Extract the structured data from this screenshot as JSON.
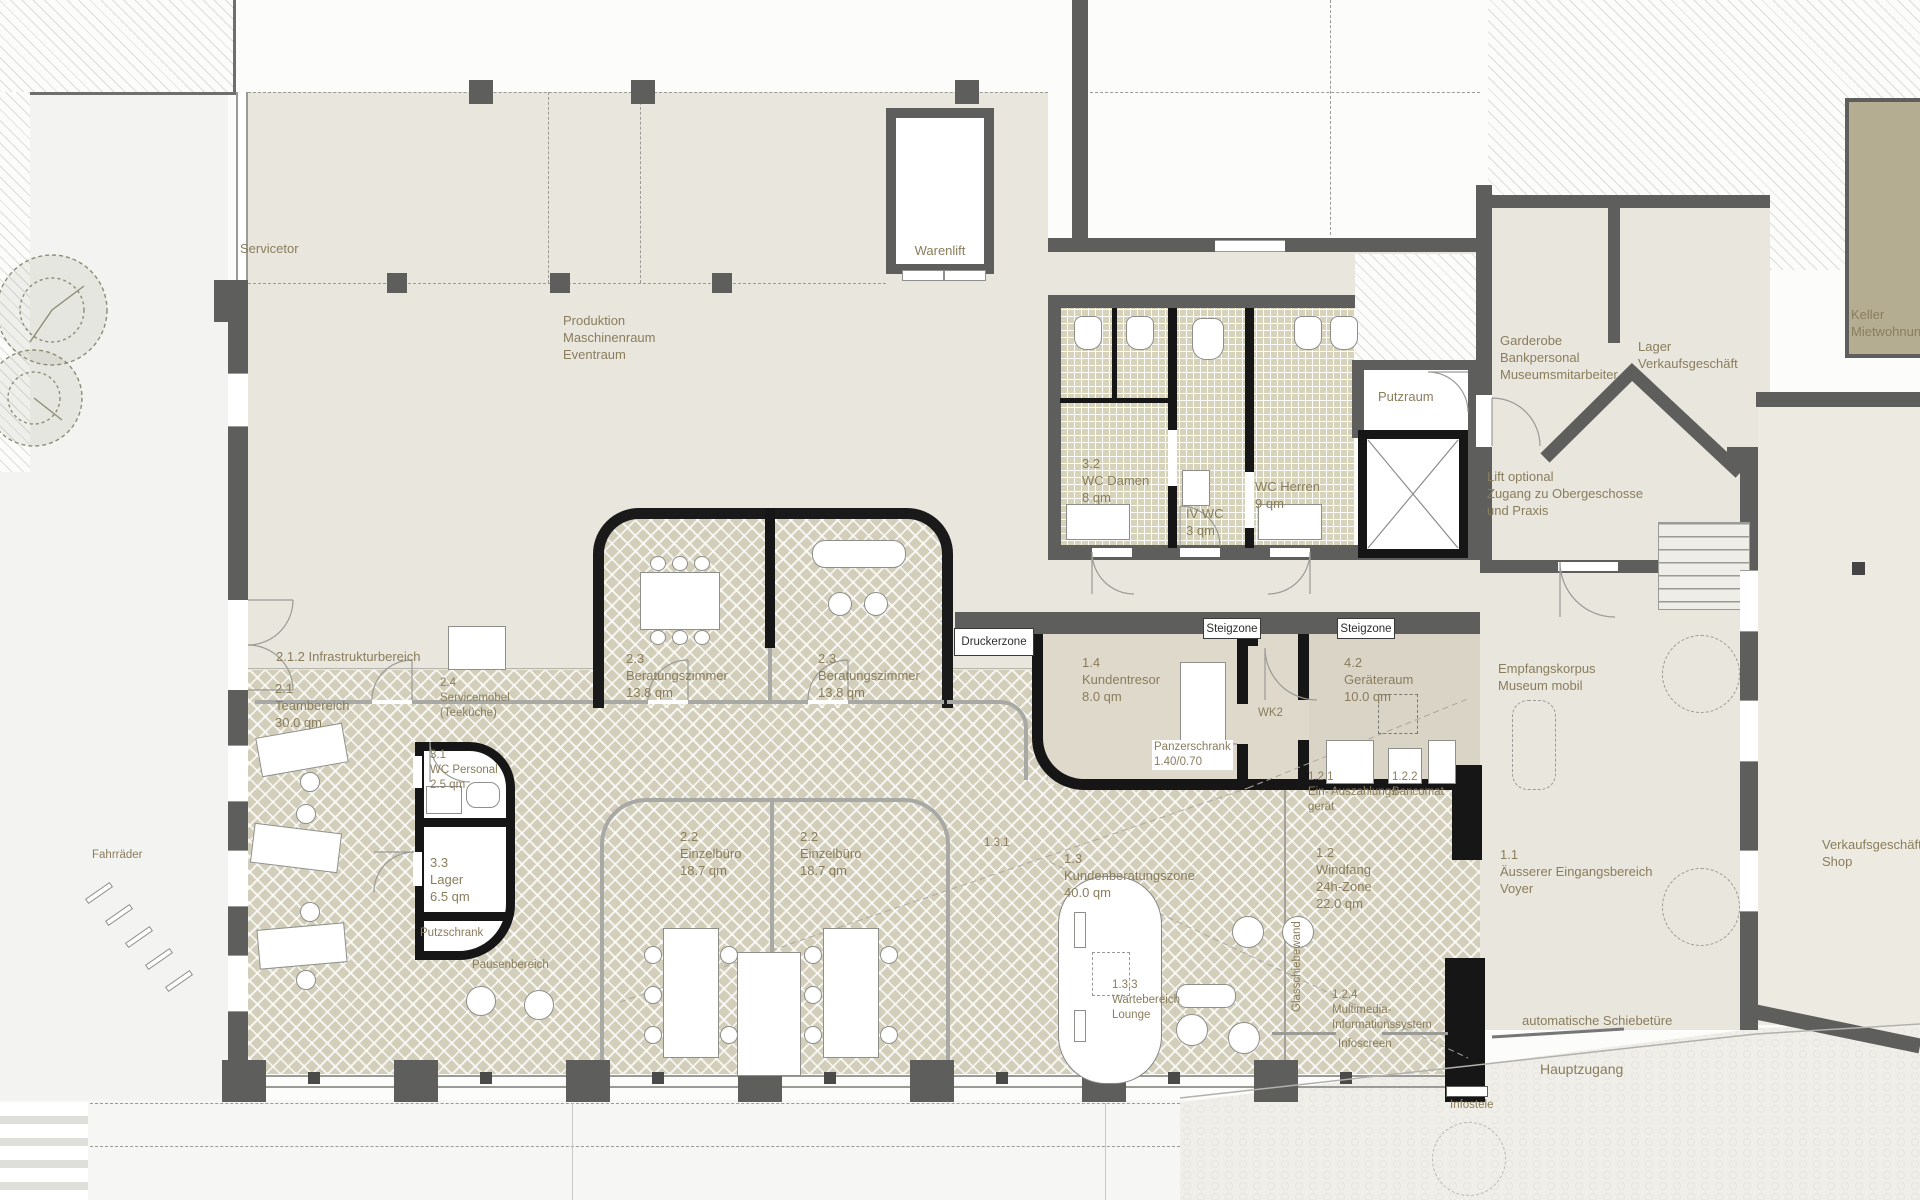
{
  "zones": {
    "exterior": {
      "servicetor": "Servicetor",
      "fahrraeder": "Fahrräder",
      "hauptzugang": "Hauptzugang",
      "infostele": "Infostele",
      "schiebetuere": "automatische Schiebetüre",
      "keller": "Keller\nMietwohnung"
    },
    "upper_hall": {
      "produktion": "Produktion\nMaschinenraum\nEventraum",
      "warenlift": "Warenlift",
      "infrastruktur": "2.1.2 Infrastrukturbereich",
      "druckerzone": "Druckerzone"
    },
    "wc_block": {
      "wc_damen": "3.2\nWC Damen\n8 qm",
      "iv_wc": "IV WC\n3 qm",
      "wc_herren": "WC Herren\n9 qm",
      "putzraum": "Putzraum"
    },
    "right_wing": {
      "garderobe": "Garderobe\nBankpersonal\nMuseumsmitarbeiter",
      "lager_verkauf": "Lager\nVerkaufsgeschäft",
      "lift_optional": "Lift optional\nZugang zu Obergeschosse\nund Praxis",
      "verkaufsgeschaeft": "Verkaufsgeschäft\nShop"
    },
    "bank": {
      "teambereich": "2.1\nTeambereich\n30.0 qm",
      "servicemoebel": "2.4\nServicemöbel\n(Teeküche)",
      "beratungszimmer": "2.3\nBeratungszimmer\n13.8 qm",
      "einzelbuero": "2.2\nEinzelbüro\n18.7 qm",
      "wc_personal": "3.1\nWC Personal\n2.5 qm",
      "lager": "3.3\nLager\n6.5 qm",
      "putzschrank": "Putzschrank",
      "pausenbereich": "Pausenbereich",
      "kundentresor": "1.4\nKundentresor\n8.0 qm",
      "panzerschrank": "Panzerschrank\n1.40/0.70",
      "wk2": "WK2",
      "steigzone": "Steigzone",
      "geraeteraum": "4.2\nGeräteraum\n10.0 qm",
      "ein_auszahlung": "1.2.1\nEin- Auszahlungs-\ngerät",
      "bancomat": "1.2.2\nBancomat",
      "kundenberatung": "1.3\nKundenberatungszone\n40.0 qm",
      "beraterstation": "1.3.1",
      "windfang": "1.2\nWindfang\n24h-Zone\n22.0 qm",
      "wartebereich": "1.3.3\nWartebereich\nLounge",
      "multimedia": "1.2.4\nMultimedia-\nInformationssystem",
      "infoscreen": "Infoscreen",
      "glasschiebewand": "Glasschiebewand"
    },
    "entrance": {
      "aeusserer": "1.1\nÄusserer Eingangsbereich\nVoyer",
      "empfangskorpus": "Empfangskorpus\nMuseum mobil"
    }
  },
  "colors": {
    "wall": "#5e5e5c",
    "wall_black": "#161616",
    "floor": "#e9e6de",
    "herringbone": "#d2ceba",
    "wc_floor": "#d6d3ba",
    "keller": "#b4ad92",
    "label": "#8a7d5c"
  }
}
